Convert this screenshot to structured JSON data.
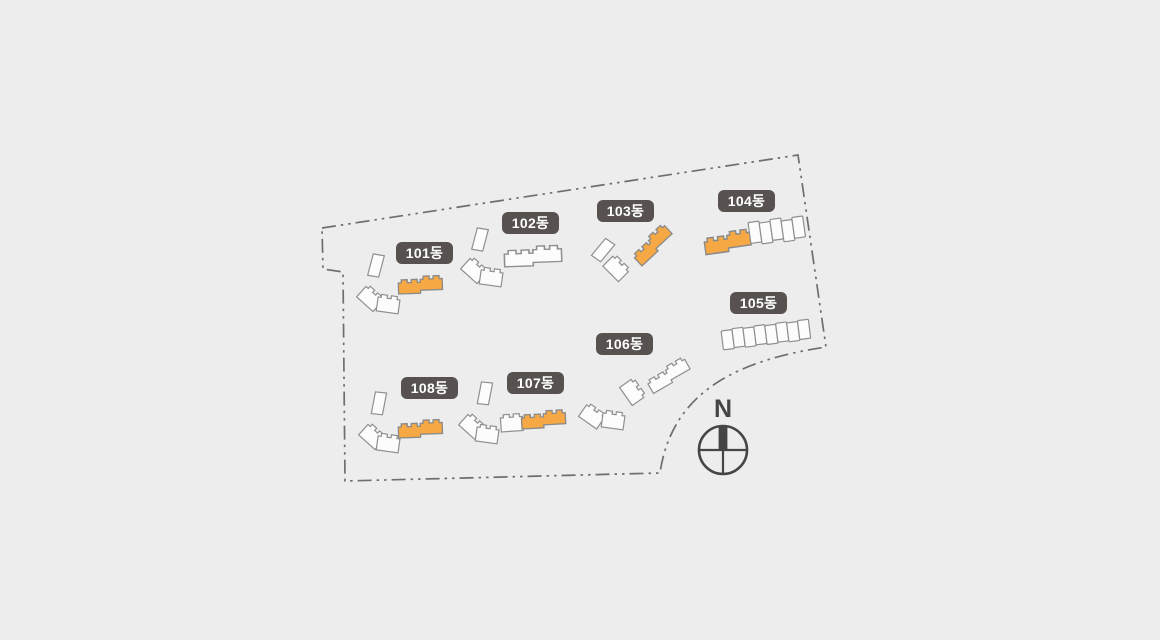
{
  "site_plan": {
    "compass": {
      "label": "N"
    },
    "buildings": [
      {
        "id": "101",
        "label": "101동",
        "highlighted": true
      },
      {
        "id": "102",
        "label": "102동",
        "highlighted": false
      },
      {
        "id": "103",
        "label": "103동",
        "highlighted": true
      },
      {
        "id": "104",
        "label": "104동",
        "highlighted": true
      },
      {
        "id": "105",
        "label": "105동",
        "highlighted": false
      },
      {
        "id": "106",
        "label": "106동",
        "highlighted": false
      },
      {
        "id": "107",
        "label": "107동",
        "highlighted": true
      },
      {
        "id": "108",
        "label": "108동",
        "highlighted": true
      }
    ],
    "colors": {
      "background": "#EDEDED",
      "boundary": "#6E6E6E",
      "building_fill": "#FCFCFC",
      "building_stroke": "#8F8F8F",
      "highlight_fill": "#F5A843",
      "highlight_stroke": "#8A8A8A",
      "label_bg": "#575250",
      "label_text": "#FFFFFF",
      "compass": "#454545"
    }
  }
}
